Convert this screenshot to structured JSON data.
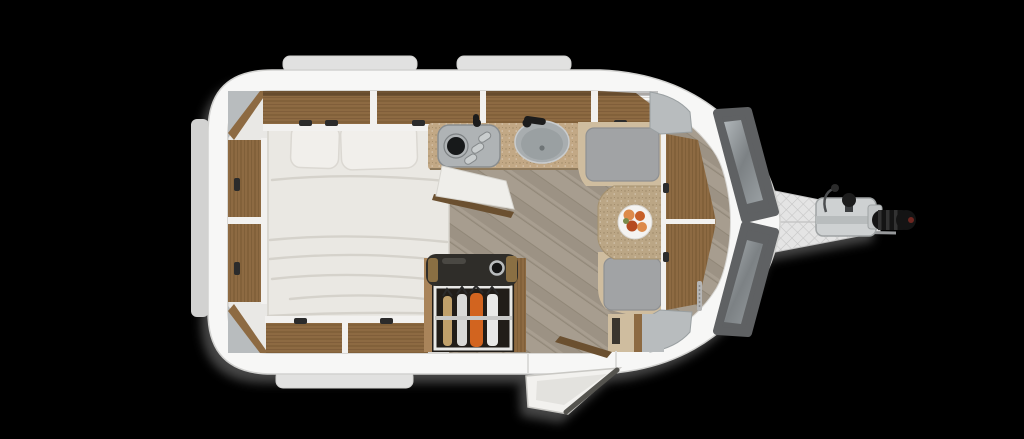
{
  "scene": {
    "type": "caravan-floorplan",
    "view": "top-down",
    "orientation": "hitch-right"
  },
  "elements": {
    "bed": "double-bed-with-two-pillows",
    "wardrobe": "open-wardrobe-with-hanging-garments",
    "kitchen": "kitchen-block-with-hob-and-round-sink",
    "dinette": "front-dinette-with-table-and-fruit-bowl",
    "front_bench": "v-shaped-front-bench",
    "entry": "open-entry-door-bottom-right",
    "chassis": "a-frame-drawbar-with-hitch-coupling"
  },
  "colors": {
    "background": "#000000",
    "shadow": "#8c8c8c",
    "shell": "#f7f7f6",
    "shellEdge": "#d2d2d0",
    "wallInner": "#d8d7d4",
    "windowBump": "#e1e1e0",
    "windowBumpSide": "#d2d2d1",
    "interiorBase": "#e9e8e5",
    "floorBase": "#a79d8f",
    "floorAlt": "#9c9284",
    "floorLine": "#8a8171",
    "wood": "#8d6a42",
    "woodDark": "#6b5030",
    "woodLight": "#a9845a",
    "trim": "#f2f1ef",
    "cornerGray": "#b8bcbe",
    "cornerEdge": "#9aa0a2",
    "counter": "#c2a885",
    "counterEdge": "#8f7a5c",
    "table": "#bba685",
    "seat": "#a1a3a5",
    "seatEdge": "#8e9092",
    "sand": "#cfbd9f",
    "bed": "#eae8e3",
    "bedFold": "#d5d2cb",
    "pillow": "#f1efeb",
    "pillowEdge": "#dbd8d2",
    "hob": "#afb3b5",
    "hobEdge": "#898d8f",
    "burner": "#17191a",
    "knob": "#c9cdce",
    "sink": "#a8adaf",
    "sinkInner": "#9aa0a2",
    "black": "#1c1c1c",
    "panelDark": "#5f6163",
    "drawbar": "#e4e4e4",
    "drawbarLine": "#c6c6c6",
    "hitchMetal": "#ced1d2",
    "hitchEdge": "#9fa3a4",
    "grip": "#141414",
    "gripRib": "#323232",
    "gripTip": "#6e2620",
    "wardrobeBar": "#2f2d29",
    "wardrobeGold": "#8a6f43",
    "wardrobeInterior": "#211d18",
    "wardrobeFrame": "#e8e8e6",
    "rail": "#c9c9c7",
    "garmentTan": "#c0a06a",
    "garmentWhite": "#e9e9e7",
    "garmentGray": "#d9d9d7",
    "garmentOrange": "#d2641f",
    "doorWhite": "#f2f1ee",
    "doorInner": "#e3e2de",
    "doorEdge": "#55544f",
    "bowl": "#f4f3f1",
    "fruit1": "#dd8a4a",
    "fruit2": "#c75f28",
    "fruit3": "#b54a20",
    "fruitLeaf": "#7a8a4a",
    "marking": "#b5b5b5",
    "handle": "#2b2b2b"
  }
}
